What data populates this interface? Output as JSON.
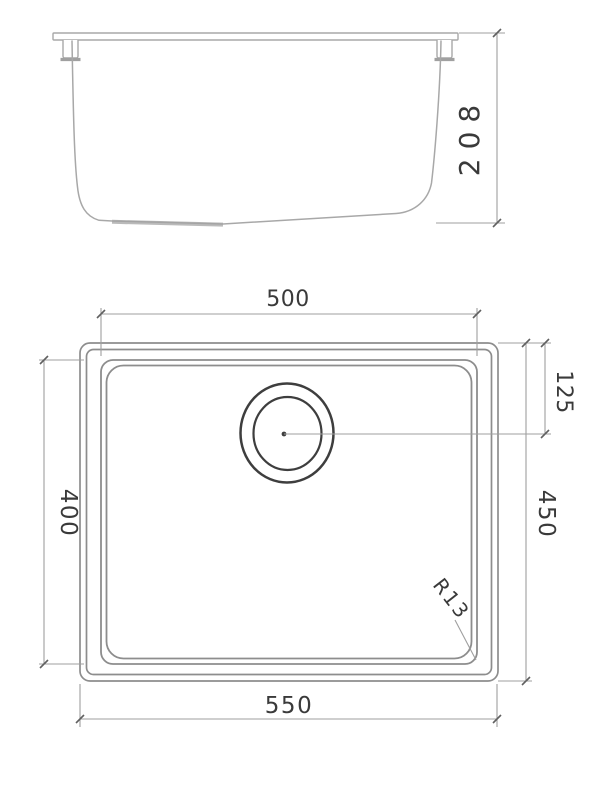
{
  "dimensions": {
    "depth": "208",
    "bowl_width": "500",
    "bowl_length": "400",
    "outer_width": "550",
    "outer_length": "450",
    "drain_offset": "125",
    "corner_radius": "R13"
  },
  "colors": {
    "background": "#ffffff",
    "elevation_outline": "#a8a8a8",
    "plan_outline": "#8d8d8d",
    "dimension_line": "#9f9f9f",
    "drain_outline": "#3e3e3e",
    "text": "#3a3a3a"
  }
}
